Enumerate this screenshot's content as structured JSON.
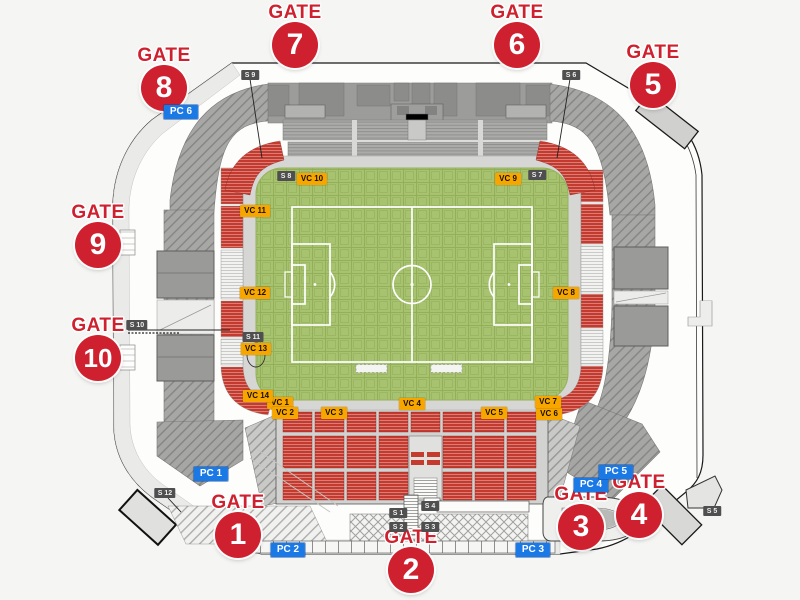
{
  "map_title": "stadium-seating-plan",
  "gate_word": "GATE",
  "gates": [
    {
      "number": "7",
      "x": 295,
      "y": 45
    },
    {
      "number": "6",
      "x": 517,
      "y": 45
    },
    {
      "number": "5",
      "x": 653,
      "y": 85
    },
    {
      "number": "8",
      "x": 164,
      "y": 88
    },
    {
      "number": "9",
      "x": 98,
      "y": 245
    },
    {
      "number": "10",
      "x": 98,
      "y": 358
    },
    {
      "number": "1",
      "x": 238,
      "y": 535
    },
    {
      "number": "2",
      "x": 411,
      "y": 570
    },
    {
      "number": "3",
      "x": 581,
      "y": 527
    },
    {
      "number": "4",
      "x": 639,
      "y": 515
    }
  ],
  "vc_sections": [
    {
      "text": "VC 1",
      "x": 280,
      "y": 403
    },
    {
      "text": "VC 2",
      "x": 285,
      "y": 413
    },
    {
      "text": "VC 3",
      "x": 334,
      "y": 413
    },
    {
      "text": "VC 4",
      "x": 412,
      "y": 404
    },
    {
      "text": "VC 5",
      "x": 494,
      "y": 413
    },
    {
      "text": "VC 6",
      "x": 549,
      "y": 414
    },
    {
      "text": "VC 7",
      "x": 548,
      "y": 402
    },
    {
      "text": "VC 8",
      "x": 566,
      "y": 293
    },
    {
      "text": "VC 9",
      "x": 508,
      "y": 179
    },
    {
      "text": "VC 10",
      "x": 312,
      "y": 179
    },
    {
      "text": "VC 11",
      "x": 255,
      "y": 211
    },
    {
      "text": "VC 12",
      "x": 255,
      "y": 293
    },
    {
      "text": "VC 13",
      "x": 256,
      "y": 349
    },
    {
      "text": "VC 14",
      "x": 258,
      "y": 396
    }
  ],
  "pc_entrances": [
    {
      "text": "PC 1",
      "x": 211,
      "y": 474
    },
    {
      "text": "PC 2",
      "x": 288,
      "y": 550
    },
    {
      "text": "PC 3",
      "x": 533,
      "y": 550
    },
    {
      "text": "PC 4",
      "x": 591,
      "y": 485
    },
    {
      "text": "PC 5",
      "x": 616,
      "y": 472
    },
    {
      "text": "PC 6",
      "x": 181,
      "y": 112
    }
  ],
  "s_points": [
    {
      "text": "S 1",
      "x": 398,
      "y": 513
    },
    {
      "text": "S 2",
      "x": 398,
      "y": 527
    },
    {
      "text": "S 3",
      "x": 430,
      "y": 527
    },
    {
      "text": "S 4",
      "x": 430,
      "y": 506
    },
    {
      "text": "S 5",
      "x": 712,
      "y": 511
    },
    {
      "text": "S 6",
      "x": 571,
      "y": 75
    },
    {
      "text": "S 7",
      "x": 537,
      "y": 175
    },
    {
      "text": "S 8",
      "x": 286,
      "y": 176
    },
    {
      "text": "S 9",
      "x": 250,
      "y": 75
    },
    {
      "text": "S 10",
      "x": 137,
      "y": 325
    },
    {
      "text": "S 11",
      "x": 253,
      "y": 337
    },
    {
      "text": "S 12",
      "x": 165,
      "y": 493
    }
  ],
  "colors": {
    "gate_red": "#ce202e",
    "vc_yellow": "#f7a600",
    "pc_blue": "#1b79e6",
    "s_gray": "#4f4f4f",
    "field_green": "#a8c370",
    "seat_red": "#c43a2e",
    "stand_gray": "#a3a3a1"
  }
}
